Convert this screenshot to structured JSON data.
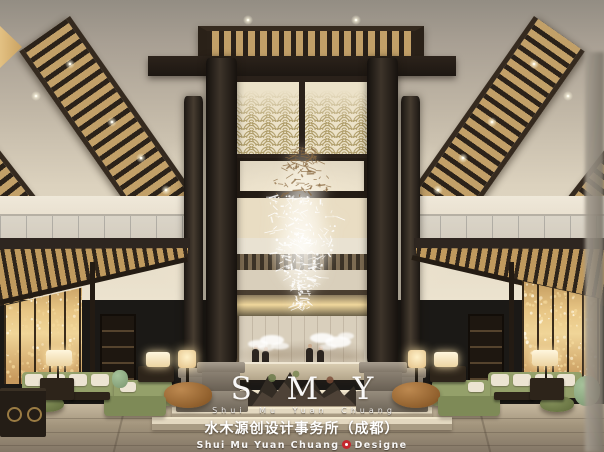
{
  "watermark": {
    "logo": "S M Y",
    "subtitle": "Shui Mu Yuan Chuang",
    "company_cn": "水木源创设计事务所（成都）",
    "en_prefix": "Shui Mu Yuan Chuang",
    "en_suffix": "Designe"
  },
  "colors": {
    "wood_dark": "#2b2219",
    "slat_gold": "#c2a068",
    "screen_gold": "#e6c487",
    "column_dark": "#241d16",
    "stone_base": "#8a8173",
    "wall_beige": "#d9cfbc",
    "sofa_green": "#94a06a",
    "ottoman_caramel": "#a06a34",
    "floor_tan": "#ab9e86",
    "celadon": "#8fae86",
    "ceiling_cream": "#e9e0cb",
    "seal_red": "#c5272e"
  }
}
